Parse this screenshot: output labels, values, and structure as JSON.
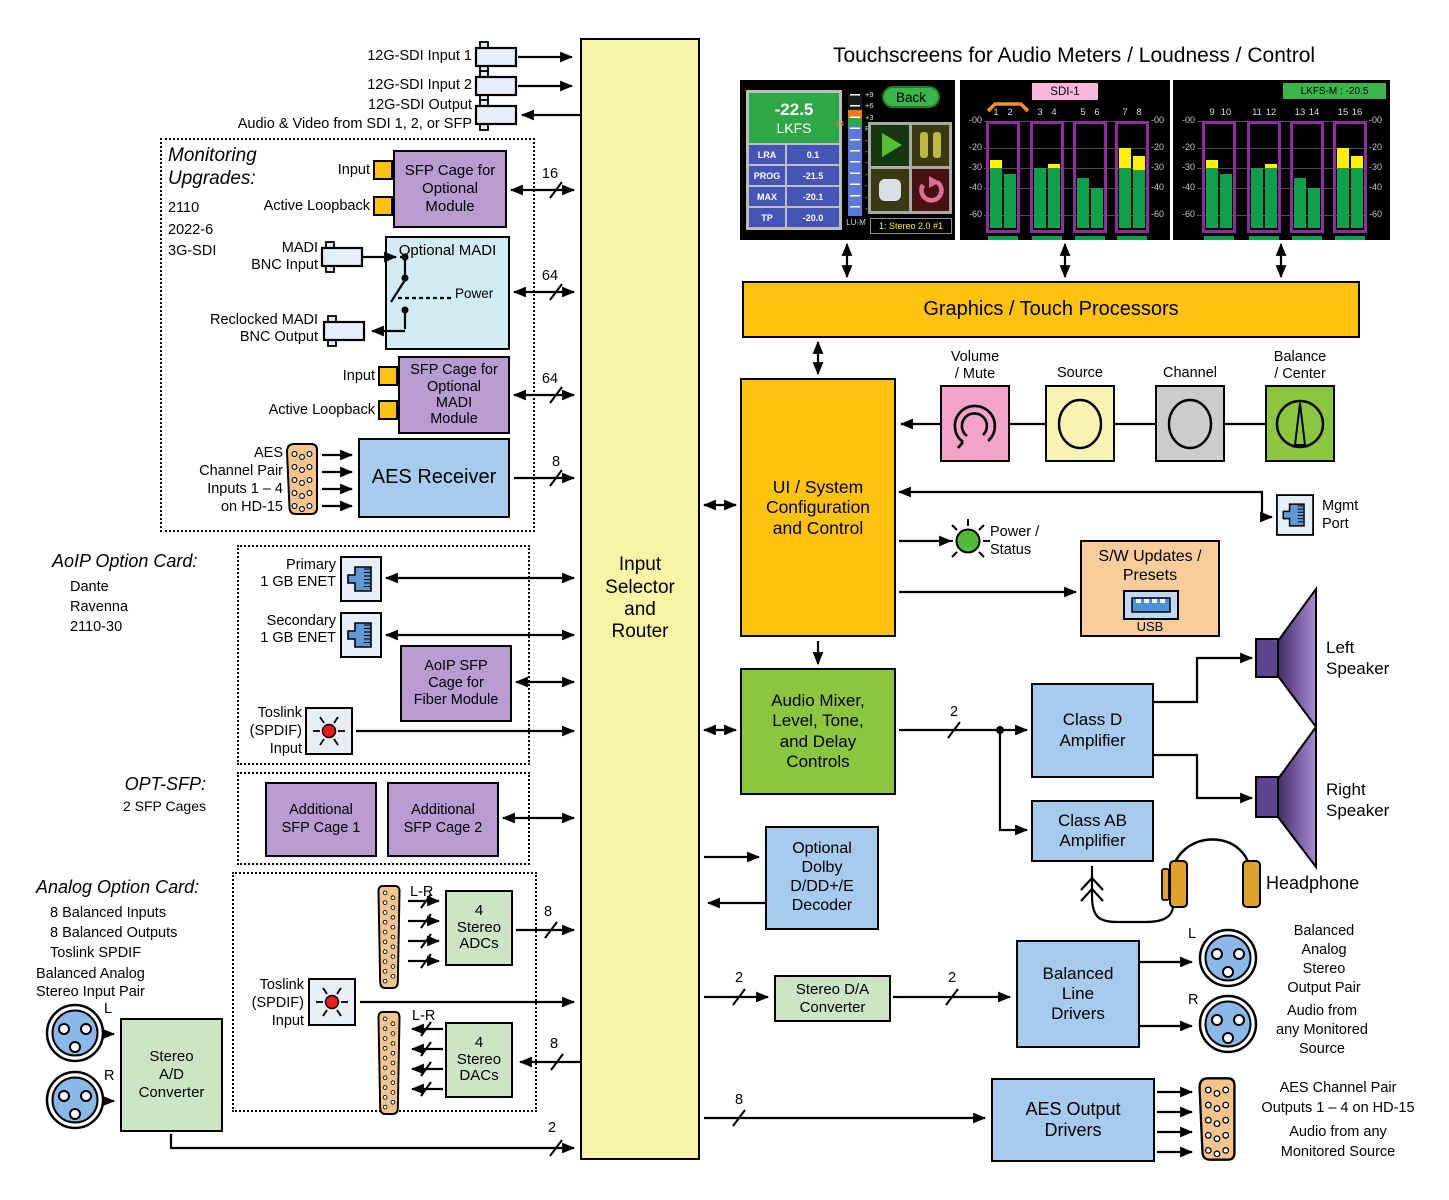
{
  "title": "Touchscreens for Audio Meters / Loudness / Control",
  "colors": {
    "gold": "#FFC20E",
    "column_yellow": "#F8F4A6",
    "green": "#8CC63F",
    "light_green": "#CBE5C5",
    "blue": "#A6CBEC",
    "cyan": "#D2ECF5",
    "purple": "#B79BD1",
    "orange": "#FACD9B",
    "connector_orange": "#F7C48D",
    "pink": "#F2A3C9",
    "speaker_purple": "#7A5BA8",
    "meter_green": "#0FA04C",
    "meter_yellow": "#FFF200",
    "meter_outline": "#8E2E9E"
  },
  "column": {
    "label": "Input\nSelector\nand\nRouter"
  },
  "sdi": {
    "input1": "12G-SDI Input 1",
    "input2": "12G-SDI Input 2",
    "output": "12G-SDI Output",
    "output_sub": "Audio & Video from SDI 1, 2, or SFP"
  },
  "monitoring": {
    "title": "Monitoring\nUpgrades:",
    "items": "2110\n2022-6\n3G-SDI",
    "sfp_cage": "SFP Cage for\nOptional\nModule",
    "input1": "Input",
    "loopback1": "Active Loopback",
    "madi_title": "Optional MADI",
    "madi_in": "MADI\nBNC Input",
    "madi_out": "Reclocked MADI\nBNC Output",
    "power": "Power",
    "madi_sfp": "SFP Cage for\nOptional\nMADI\nModule",
    "input2": "Input",
    "loopback2": "Active Loopback",
    "aes_in": "AES\nChannel Pair\nInputs 1 – 4\non HD-15",
    "aes_receiver": "AES Receiver"
  },
  "aoip": {
    "title": "AoIP Option Card:",
    "items": "Dante\nRavenna\n2110-30",
    "primary": "Primary\n1 GB ENET",
    "secondary": "Secondary\n1 GB ENET",
    "sfp_cage": "AoIP SFP\nCage for\nFiber Module",
    "toslink": "Toslink\n(SPDIF)\nInput"
  },
  "optsfp": {
    "title": "OPT-SFP:",
    "sub": "2 SFP Cages",
    "cage1": "Additional\nSFP Cage 1",
    "cage2": "Additional\nSFP Cage 2"
  },
  "analog": {
    "title": "Analog Option Card:",
    "items": "8 Balanced Inputs\n8 Balanced Outputs\nToslink SPDIF",
    "lr_top": "L-R",
    "adcs": "4\nStereo\nADCs",
    "toslink": "Toslink\n(SPDIF)\nInput",
    "lr_bottom": "L-R",
    "dacs": "4\nStereo\nDACs",
    "input_pair": "Balanced Analog\nStereo Input Pair",
    "l": "L",
    "r": "R",
    "ad": "Stereo\nA/D\nConverter"
  },
  "buses": {
    "sfp": "16",
    "madi": "64",
    "madi_sfp": "64",
    "aes_in": "8",
    "adc_out": "8",
    "dac_in": "8",
    "ad_out": "2",
    "da_in": "2",
    "da_out": "2",
    "mixer_out": "2",
    "aes_out": "8"
  },
  "core": {
    "graphics": "Graphics / Touch Processors",
    "ui": "UI / System\nConfiguration\nand Control",
    "mixer": "Audio Mixer,\nLevel, Tone,\nand Delay\nControls",
    "dolby": "Optional\nDolby\nD/DD+/E\nDecoder",
    "power_status": "Power /\nStatus",
    "sw": "S/W Updates /\nPresets",
    "usb": "USB",
    "mgmt": "Mgmt\nPort",
    "knobs": [
      {
        "label": "Volume\n/ Mute"
      },
      {
        "label": "Source"
      },
      {
        "label": "Channel"
      },
      {
        "label": "Balance\n/ Center"
      }
    ]
  },
  "output": {
    "class_d": "Class D\nAmplifier",
    "class_ab": "Class AB\nAmplifier",
    "left_speaker": "Left\nSpeaker",
    "right_speaker": "Right\nSpeaker",
    "headphone": "Headphone",
    "da": "Stereo D/A\nConverter",
    "line_drivers": "Balanced\nLine\nDrivers",
    "l": "L",
    "r": "R",
    "pair": "Balanced\nAnalog\nStereo\nOutput Pair",
    "pair_note": "Audio from\nany Monitored\nSource",
    "aes_drivers": "AES Output\nDrivers",
    "aes_label": "AES Channel Pair\nOutputs 1 – 4  on HD-15",
    "aes_note": "Audio from any\nMonitored Source"
  },
  "screens": {
    "loudness": {
      "value": "-22.5",
      "unit": "LKFS",
      "stats": [
        [
          "LRA",
          "0.1"
        ],
        [
          "PROG",
          "-21.5"
        ],
        [
          "MAX",
          "-20.1"
        ],
        [
          "TP",
          "-20.0"
        ]
      ],
      "scale": [
        "+9",
        "+6",
        "+3",
        "Ref",
        "-3",
        "-6",
        "-9",
        "-12",
        "-15",
        "-18",
        "-21"
      ],
      "ref": "-24",
      "meter": "LU-M",
      "back": "Back",
      "status": "1: Stereo 2.0 #1"
    },
    "meters1": {
      "title": "SDI-1",
      "channels": [
        "1",
        "2",
        "3",
        "4",
        "5",
        "6",
        "7",
        "8"
      ],
      "scale": [
        "-00",
        "-20",
        "-30",
        "-40",
        "-60"
      ],
      "bars": [
        {
          "green": -30,
          "yellow": -26
        },
        {
          "green": -33
        },
        {
          "green": -30
        },
        {
          "green": -30,
          "yellow": -28
        },
        {
          "green": -35
        },
        {
          "green": -40
        },
        {
          "green": -30,
          "yellow": -20
        },
        {
          "green": -31,
          "yellow": -24
        }
      ]
    },
    "meters2": {
      "badge": "LKFS-M : -20.5",
      "channels": [
        "9",
        "10",
        "11",
        "12",
        "13",
        "14",
        "15",
        "16"
      ],
      "scale": [
        "-00",
        "-20",
        "-30",
        "-40",
        "-60"
      ],
      "bars": [
        {
          "green": -30,
          "yellow": -26
        },
        {
          "green": -33
        },
        {
          "green": -30
        },
        {
          "green": -30,
          "yellow": -28
        },
        {
          "green": -35
        },
        {
          "green": -40
        },
        {
          "green": -30,
          "yellow": -20
        },
        {
          "green": -30,
          "yellow": -24
        }
      ]
    }
  }
}
